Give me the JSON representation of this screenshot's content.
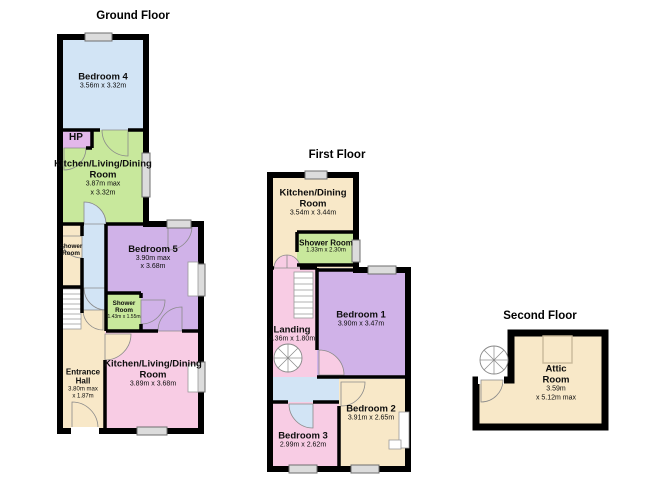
{
  "document_type": "floorplan",
  "colors": {
    "wall": "#000000",
    "room_blue": "#d2e4f5",
    "room_green": "#c8e89c",
    "room_lavender": "#d0b2e8",
    "room_purple_hp": "#e3b7ea",
    "room_cream": "#f8e8c8",
    "room_pink": "#f8cce4",
    "window_gray": "#dcdcdc"
  },
  "floors": [
    {
      "title": "Ground Floor",
      "rooms": [
        {
          "name": "Bedroom 4",
          "dims1": "3.56m x 3.32m"
        },
        {
          "name": "HP"
        },
        {
          "name": "Kitchen/Living/Dining Room",
          "dims1": "3.87m max",
          "dims2": "x 3.32m"
        },
        {
          "name": "Shower Room"
        },
        {
          "name": "Bedroom 5",
          "dims1": "3.90m max",
          "dims2": "x 3.68m"
        },
        {
          "name": "Shower Room",
          "dims1": "1.43m x 1.55m"
        },
        {
          "name": "Entrance Hall",
          "dims1": "3.80m max",
          "dims2": "x 1.87m"
        },
        {
          "name": "Kitchen/Living/Dining Room",
          "dims1": "3.89m x 3.68m"
        }
      ]
    },
    {
      "title": "First Floor",
      "rooms": [
        {
          "name": "Kitchen/Dining Room",
          "dims1": "3.54m x 3.44m"
        },
        {
          "name": "Shower Room",
          "dims1": "1.33m x 2.30m"
        },
        {
          "name": "Bedroom 1",
          "dims1": "3.90m x 3.47m"
        },
        {
          "name": "Landing",
          "dims1": "4.36m x 1.80m"
        },
        {
          "name": "Bedroom 2",
          "dims1": "3.91m x 2.65m"
        },
        {
          "name": "Bedroom 3",
          "dims1": "2.99m x 2.62m"
        }
      ]
    },
    {
      "title": "Second Floor",
      "rooms": [
        {
          "name": "Attic Room",
          "dims1": "3.59m",
          "dims2": "x 5.12m max"
        }
      ]
    }
  ]
}
